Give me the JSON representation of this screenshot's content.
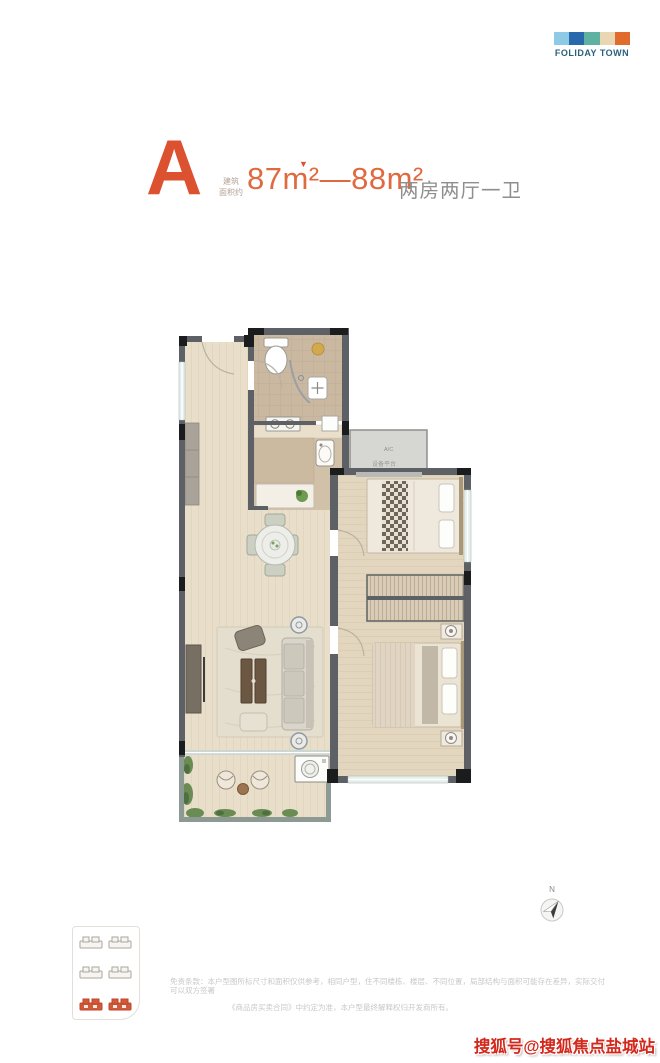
{
  "logo": {
    "text": "FOLIDAY TOWN",
    "text_color": "#2b5f7e",
    "block_colors": [
      "#8ec9e5",
      "#2a68ad",
      "#5fb2a1",
      "#e9d7b3",
      "#e06b2c"
    ]
  },
  "title": {
    "unit": "A",
    "unit_color": "#dc5130",
    "area_note_line1": "建筑",
    "area_note_line2": "面积约",
    "marker": "▼",
    "area_value": "87m²—88m²",
    "area_color": "#e06a40",
    "layout": "两房两厅一卫",
    "layout_color": "#8e8e8e"
  },
  "floorplan": {
    "ac_label": "A/C",
    "platform_label": "设备平台"
  },
  "keyplan": {
    "highlight_color": "#c8472a"
  },
  "north": {
    "label": "N"
  },
  "disclaimer": {
    "line1": "免责条款：本户型图所标尺寸和面积仅供参考，相同户型，住不同楼栋、楼层、不同位置，局部结构与面积可能存在差异，实际交付可以双方签署",
    "line2": "《商品房买卖合同》中约定为准，本户型最终解释权归开发商所有。"
  },
  "watermark": {
    "text": "搜狐号@搜狐焦点盐城站",
    "color": "#d3281c"
  }
}
